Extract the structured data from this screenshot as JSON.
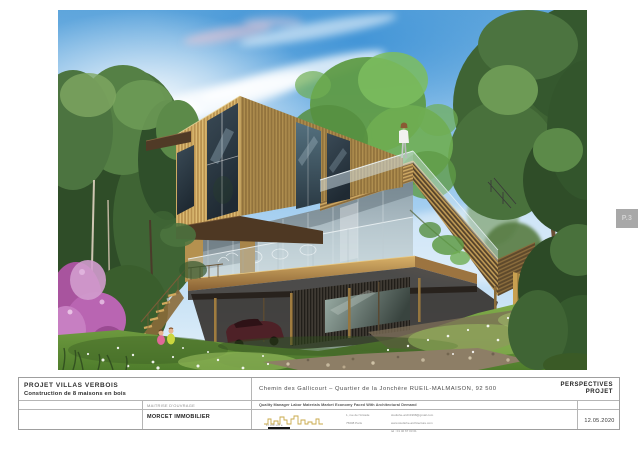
{
  "page": {
    "tab_label": "P.3"
  },
  "title_block": {
    "project": {
      "title": "PROJET VILLAS VERBOIS",
      "subtitle": "Construction de 8 maisons en bois"
    },
    "client": {
      "label": "MAITRISE D'OUVRAGE",
      "name": "MORCET IMMOBILIER"
    },
    "address": "Chemin des Gallicourt – Quartier de la Jonchère RUEIL-MALMAISON, 92 500",
    "tagline": "Quality Manager Labor Materials Market Economy Faced With Architectural Demand",
    "sheet_type": {
      "line1": "PERSPECTIVES",
      "line2": "PROJET"
    },
    "date": "12.05.2020",
    "architect": {
      "logo_text": "studiohe",
      "address_line1": "1, rue de l'Arcade",
      "address_line2": "75008 Paris",
      "contact_line1": "studiohe-archi1998@gmail.com",
      "contact_line2": "www.studiohe-architecture.com",
      "contact_line3": "tel : 01 40 67 03 01"
    }
  },
  "rendering": {
    "colors": {
      "sky_blue": "#5ea5dc",
      "cloud_white": "#ffffff",
      "wood_light": "#dcba72",
      "wood_mid": "#b9924f",
      "wood_dark": "#55422a",
      "fascia_brown": "#4e3823",
      "glass_gray": "#8fa2ac",
      "window_dark": "#2b3a44",
      "grass_green": "#6f9c3a",
      "foliage_dark": "#35582e",
      "foliage_light": "#6fae52",
      "flower_purple": "#b965b2",
      "car_red": "#4e2127",
      "tab_gray": "#a8a8a8"
    }
  }
}
